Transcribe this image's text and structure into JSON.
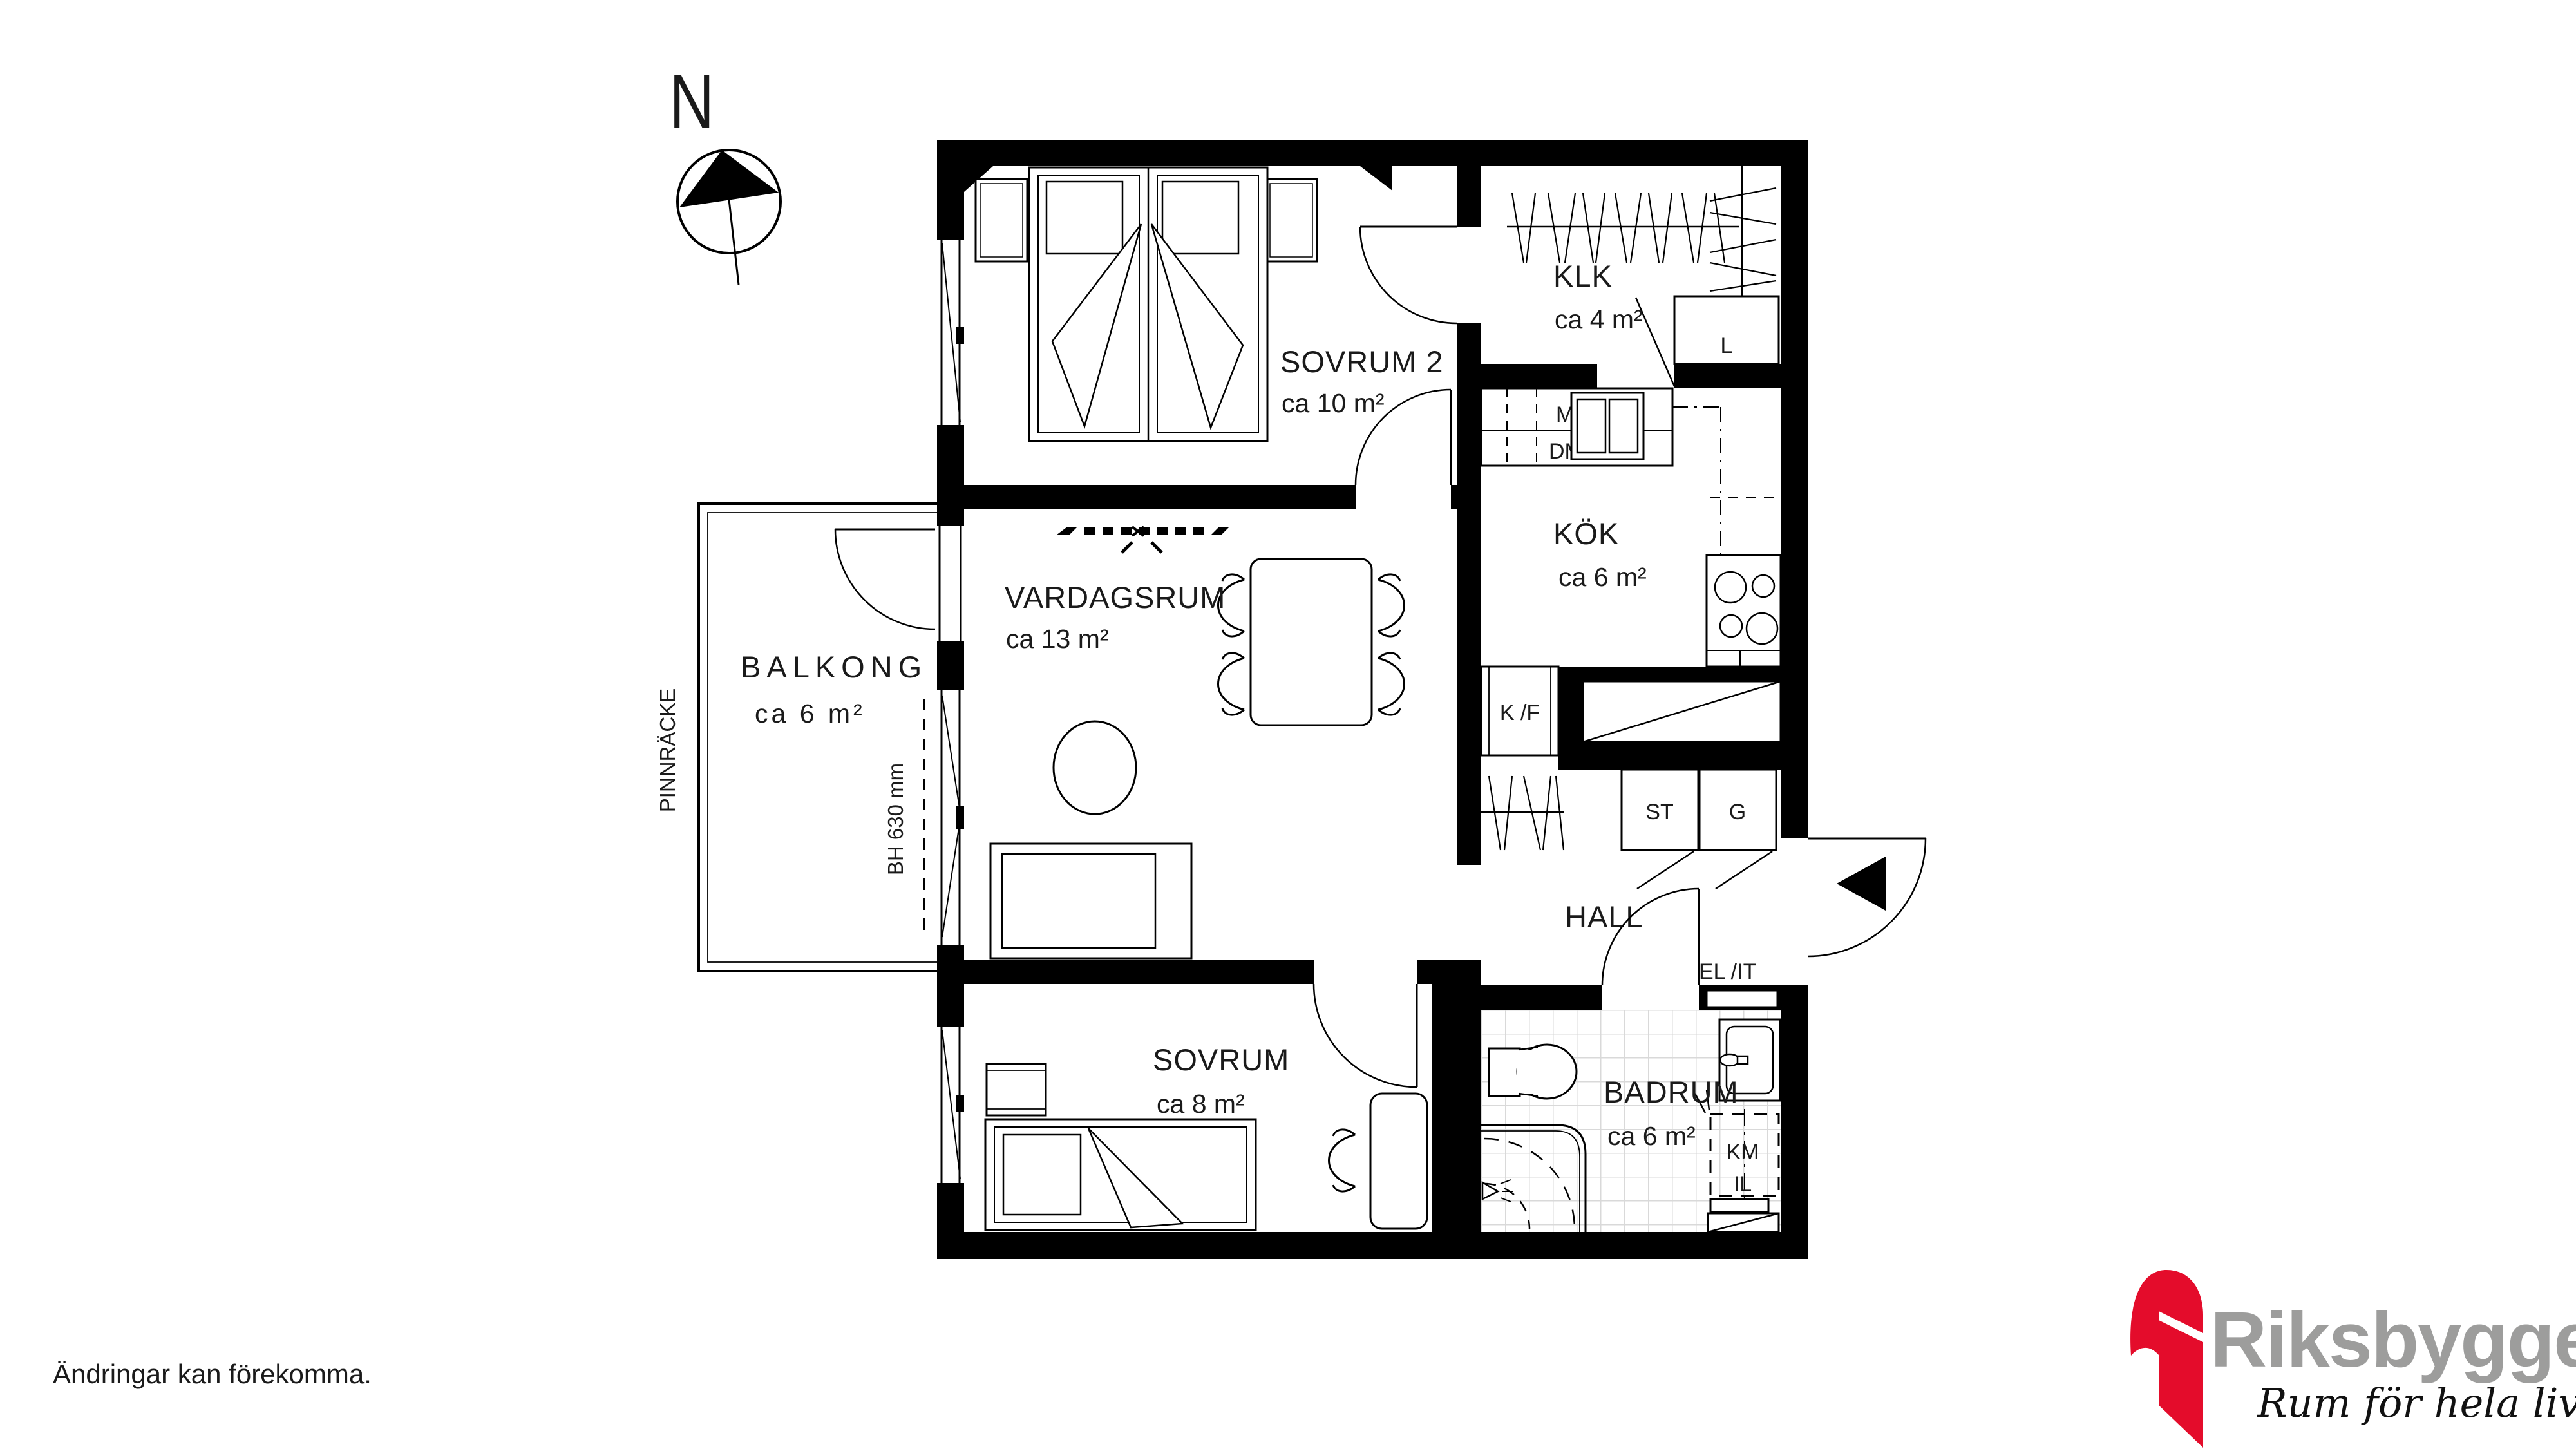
{
  "compass": {
    "label": "N"
  },
  "rooms": {
    "sovrum2": {
      "name": "SOVRUM 2",
      "area": "ca 10 m²"
    },
    "klk": {
      "name": "KLK",
      "area": "ca 4 m²"
    },
    "kok": {
      "name": "KÖK",
      "area": "ca 6 m²"
    },
    "vardagsrum": {
      "name": "VARDAGSRUM",
      "area": "ca 13 m²"
    },
    "balkong": {
      "name": "BALKONG",
      "area": "ca 6 m²"
    },
    "hall": {
      "name": "HALL"
    },
    "sovrum": {
      "name": "SOVRUM",
      "area": "ca 8 m²"
    },
    "badrum": {
      "name": "BADRUM",
      "area": "ca 6 m²"
    }
  },
  "fixtures": {
    "microwave": "M",
    "dishwasher": "DM",
    "linen_cabinet": "L",
    "fridge_freezer": "K /F",
    "cleaning_cabinet": "ST",
    "wardrobe": "G",
    "el_it": "EL /IT",
    "washing_machine": "KM",
    "laundry_il": "IL"
  },
  "annotations": {
    "railing": "PINNRÄCKE",
    "window_sill_height": "BH 630 mm",
    "disclaimer": "Ändringar kan förekomma."
  },
  "logo": {
    "brand": "Riksbyggen",
    "tagline": "Rum för hela livet"
  },
  "colors": {
    "wall": "#000000",
    "tile_line": "#d9d9d9",
    "logo_red": "#e40c2b",
    "logo_gray": "#9d9d9c"
  }
}
